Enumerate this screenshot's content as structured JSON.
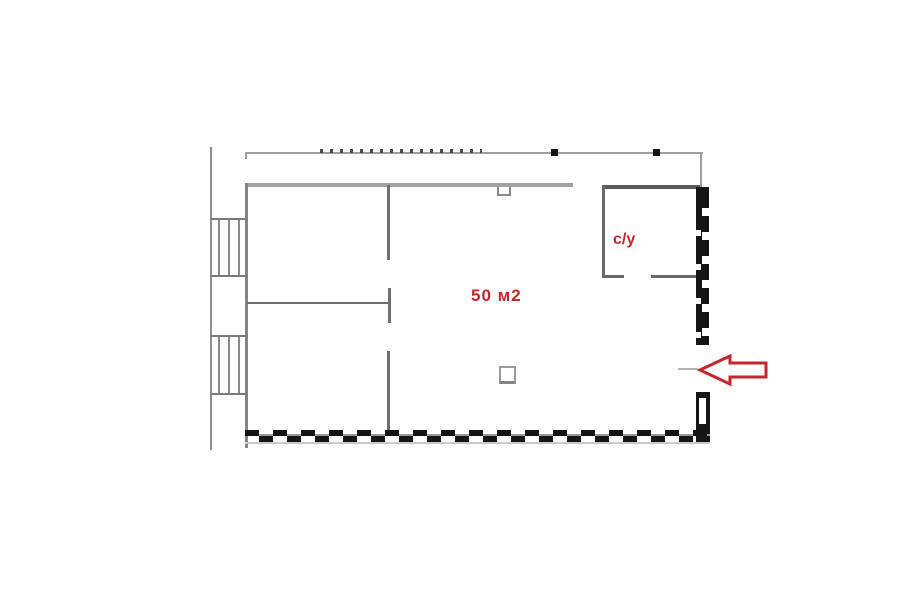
{
  "floor_plan": {
    "area_label": "50 м2",
    "bathroom_label": "с/у",
    "entrance_arrow_icon": "left-arrow",
    "colors": {
      "accent_red": "#c5262c",
      "wall_light_gray": "#9e9e9e",
      "wall_medium_gray": "#6f6f6f",
      "wall_dark": "#161616"
    }
  }
}
